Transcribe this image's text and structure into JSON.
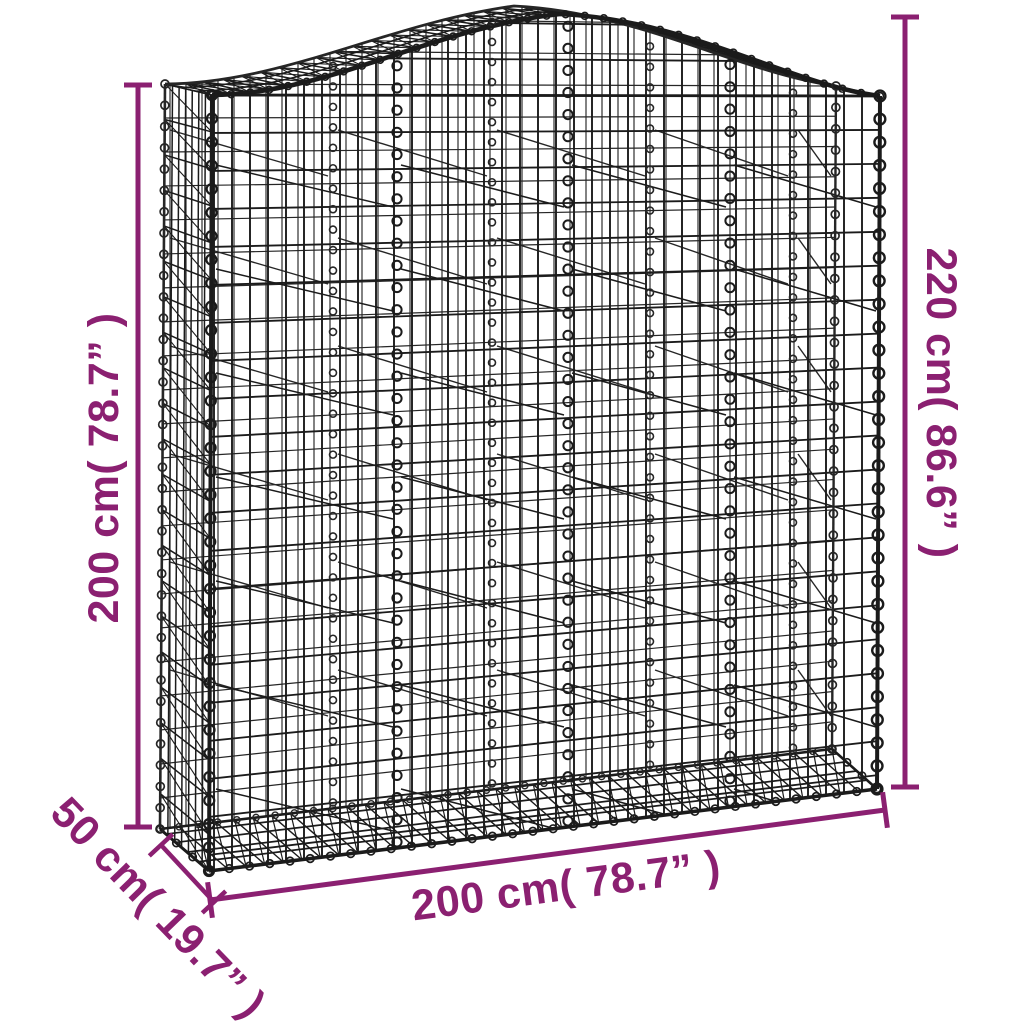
{
  "diagram": {
    "name": "arched-gabion-basket-dimension-diagram",
    "background": "#ffffff",
    "wire_color": "#1b1b1b",
    "wire_color_secondary": "#262626",
    "dimension_color": "#8b2071",
    "labels": {
      "left_height": "200 cm( 78.7” )",
      "right_height": "220 cm( 86.6” )",
      "width": "200 cm( 78.7” )",
      "depth": "50 cm( 19.7” )"
    }
  }
}
